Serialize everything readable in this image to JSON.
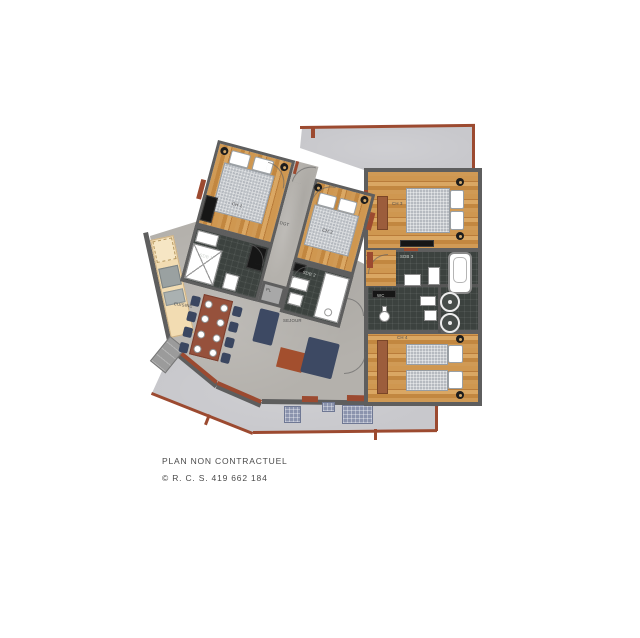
{
  "plan": {
    "rooms": {
      "ch1": "CH 1",
      "ch2": "CH 2",
      "ch3": "CH 3",
      "ch4": "CH 4",
      "dgt": "DGT",
      "sdb1": "SDB 1",
      "sdb2": "SDB 2",
      "sdb3": "SDB 3",
      "wc": "WC",
      "pl": "PL",
      "cuisine": "CUISINE",
      "sejour": "SEJOUR"
    },
    "palette": {
      "wall": "#5e5e5e",
      "wood": "#cf9750",
      "bath_tile": "#3c423f",
      "terrace": "#c8c8cc",
      "living_floor": "#b4b1ac",
      "accent_sienna": "#9c4a30",
      "sofa_navy": "#3d4963",
      "kitchen_cream": "#f2dcb2",
      "duvet_gray": "#b6bac0"
    }
  },
  "footer": {
    "line1": "PLAN NON CONTRACTUEL",
    "line2": "© R. C. S. 419 662 184"
  }
}
